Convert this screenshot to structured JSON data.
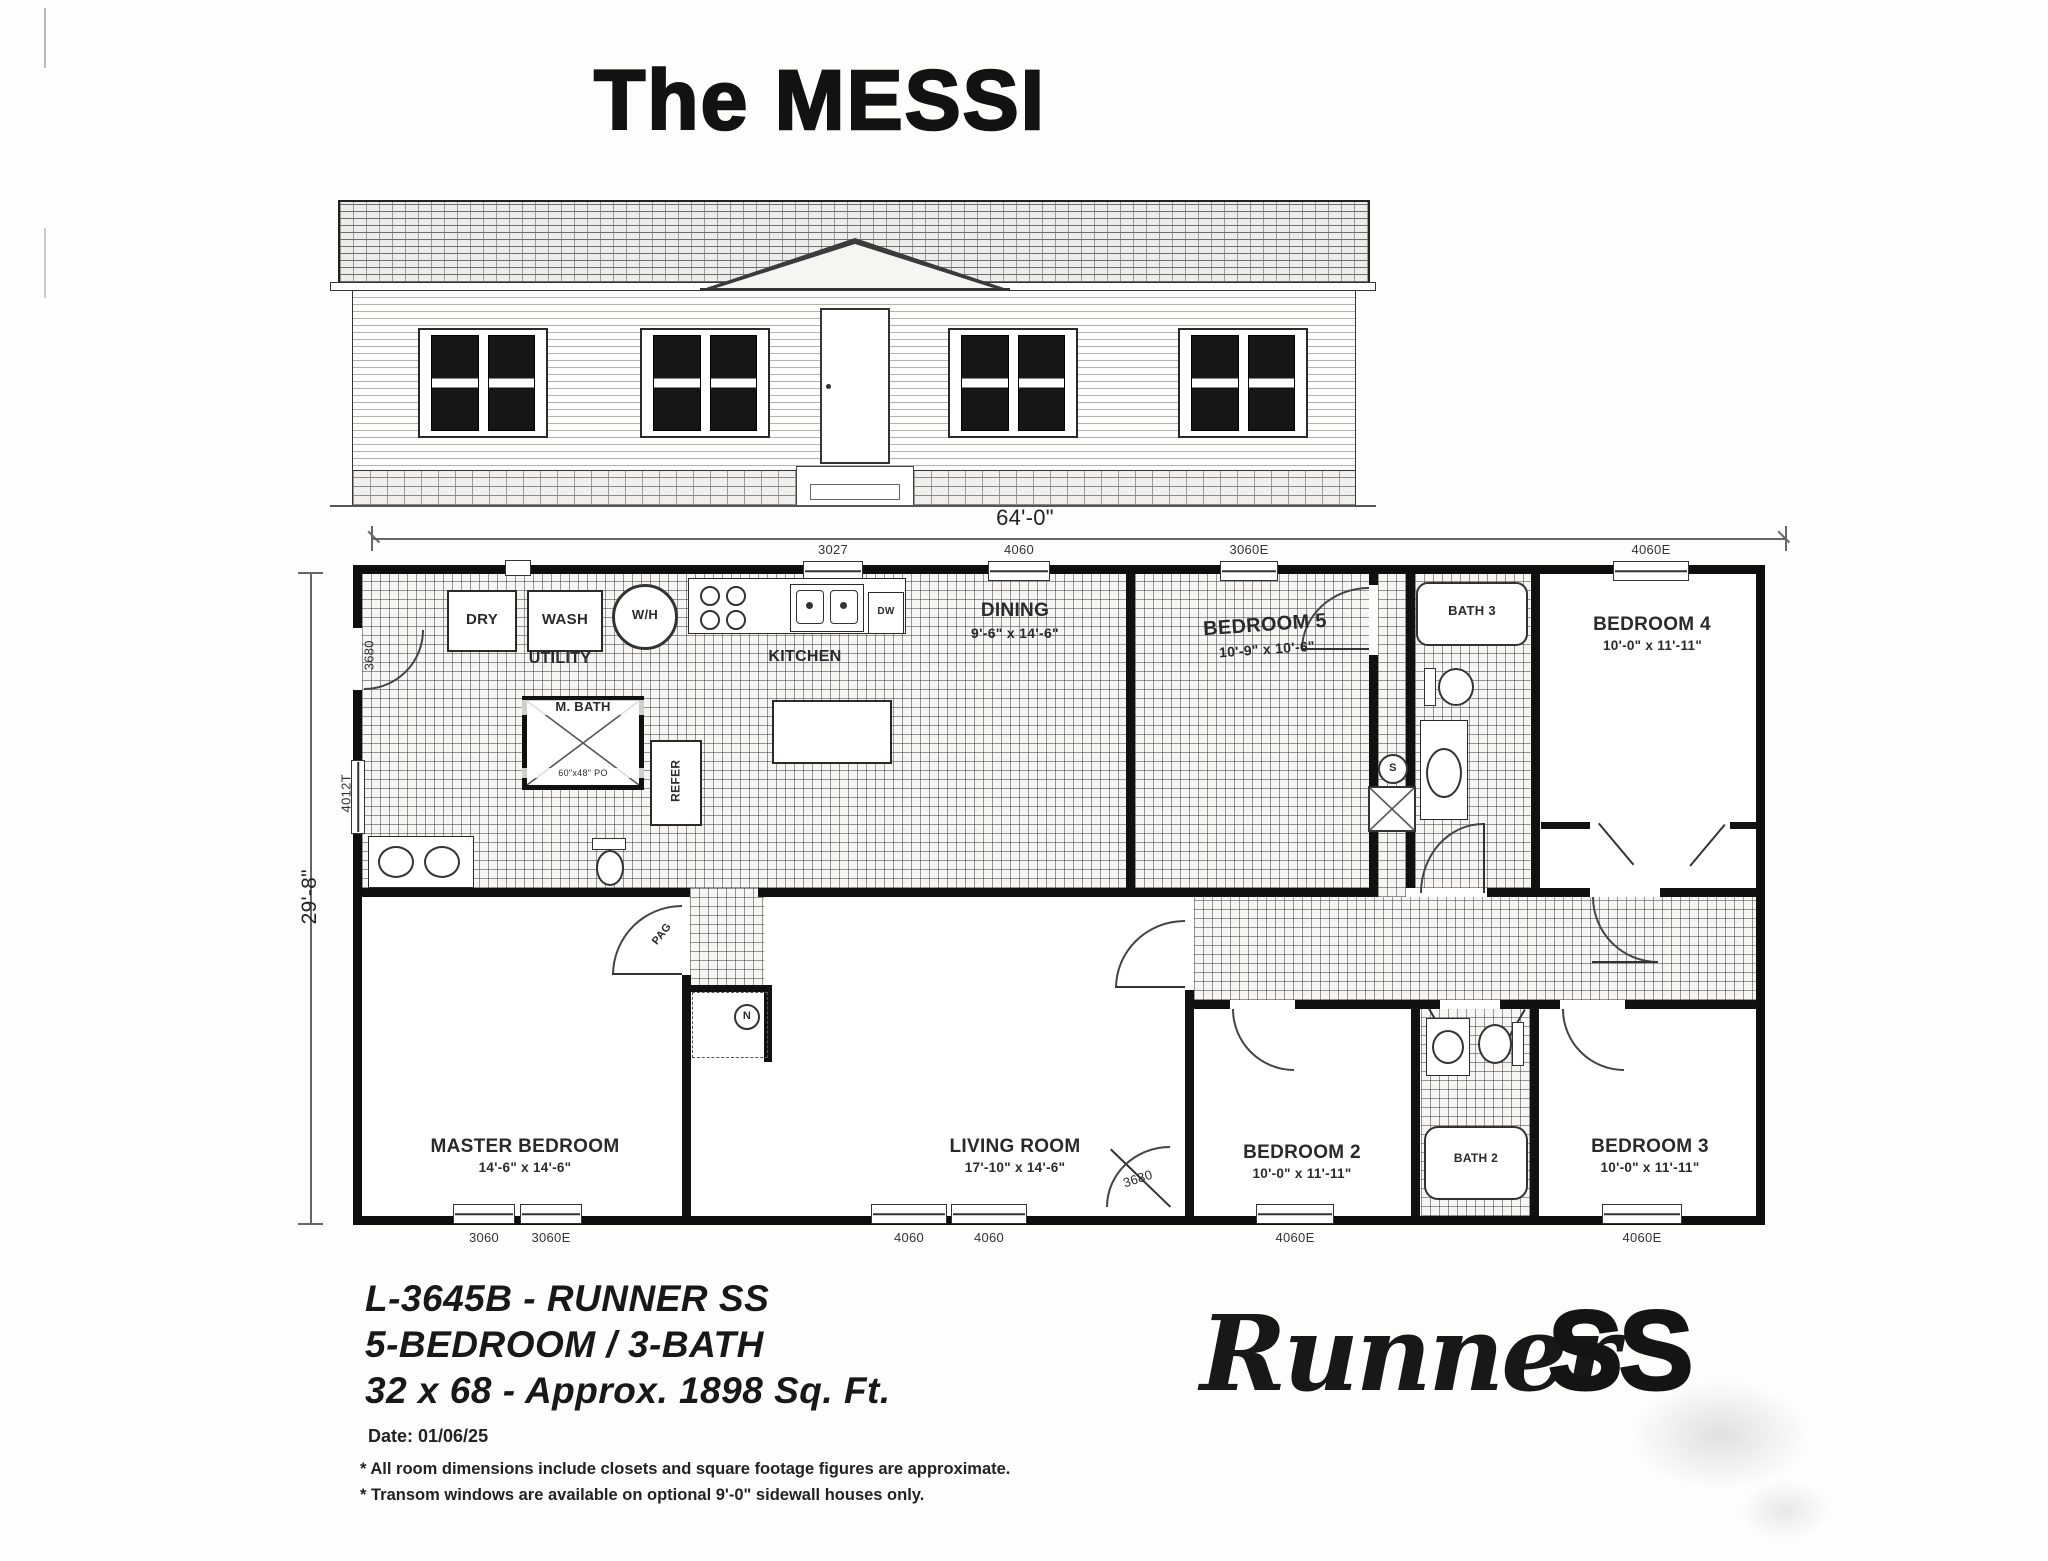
{
  "title": "The MESSI",
  "dims": {
    "width": "64'-0\"",
    "height": "29'-8\""
  },
  "plan": {
    "rooms": {
      "utility": {
        "name": "UTILITY"
      },
      "kitchen": {
        "name": "KITCHEN"
      },
      "dining": {
        "name": "DINING",
        "size": "9'-6\" x 14'-6\""
      },
      "bedroom5": {
        "name": "BEDROOM 5",
        "size": "10'-9\" x 10'-6\""
      },
      "bath3": {
        "name": "BATH 3"
      },
      "bedroom4": {
        "name": "BEDROOM 4",
        "size": "10'-0\" x 11'-11\""
      },
      "master": {
        "name": "MASTER BEDROOM",
        "size": "14'-6\" x 14'-6\""
      },
      "living": {
        "name": "LIVING ROOM",
        "size": "17'-10\" x 14'-6\""
      },
      "bedroom2": {
        "name": "BEDROOM 2",
        "size": "10'-0\" x 11'-11\""
      },
      "bath2": {
        "name": "BATH 2"
      },
      "bedroom3": {
        "name": "BEDROOM 3",
        "size": "10'-0\" x 11'-11\""
      },
      "mbath": {
        "name": "M. BATH",
        "size": "60\"x48\" PO"
      }
    },
    "fixtures": {
      "dryer": "DRY",
      "washer": "WASH",
      "water_heater": "W/H",
      "dishwasher": "DW",
      "refrigerator": "REFER",
      "pag": "PAG",
      "shower": "S",
      "nook": "N"
    },
    "openings": {
      "top": [
        "3027",
        "4060",
        "3060E",
        "4060E"
      ],
      "bottom": [
        "3060",
        "3060E",
        "4060",
        "4060",
        "3680",
        "4060E",
        "4060E"
      ],
      "left_door": "3680",
      "left_window": "4012T"
    }
  },
  "footer": {
    "model": "L-3645B - RUNNER SS",
    "config": "5-BEDROOM / 3-BATH",
    "size": "32 x 68 - Approx. 1898 Sq. Ft.",
    "date": "Date: 01/06/25",
    "note1": "* All room dimensions include closets and square footage figures are approximate.",
    "note2": "* Transom windows are available on optional 9'-0\" sidewall houses only.",
    "logo_script": "Runner",
    "logo_bold": "SS"
  }
}
